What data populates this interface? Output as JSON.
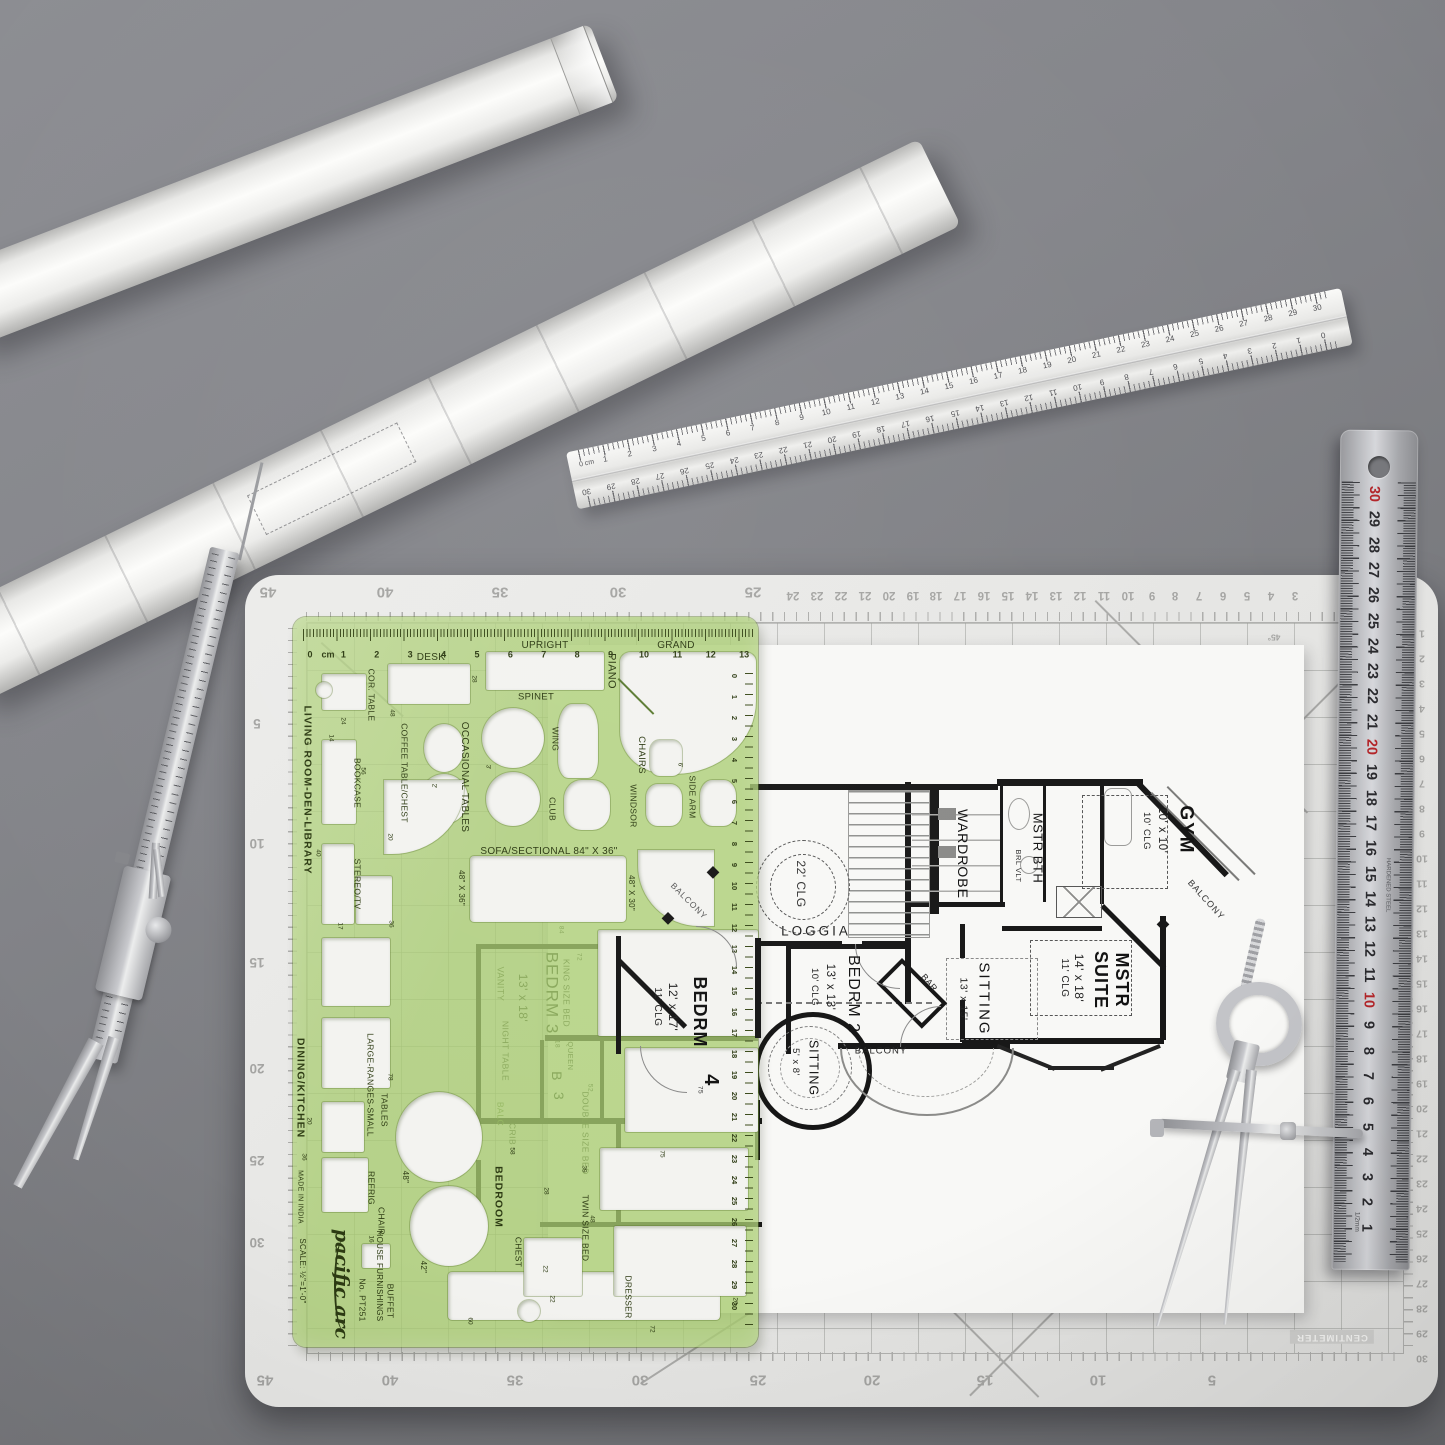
{
  "mat": {
    "top_major": [
      "45",
      "40",
      "35",
      "30",
      "25"
    ],
    "top_minor": [
      "24",
      "23",
      "22",
      "21",
      "20",
      "19",
      "18",
      "17",
      "16",
      "15",
      "14",
      "13",
      "12",
      "11",
      "10",
      "9",
      "8",
      "7",
      "6",
      "5",
      "4",
      "3"
    ],
    "bottom": [
      "45",
      "40",
      "35",
      "30",
      "25",
      "20",
      "15",
      "10",
      "5"
    ],
    "left": [
      "5",
      "10",
      "15",
      "20",
      "25",
      "30"
    ],
    "right": [
      "1",
      "2",
      "3",
      "4",
      "5",
      "6",
      "7",
      "8",
      "9",
      "10",
      "11",
      "12",
      "13",
      "14",
      "15",
      "16",
      "17",
      "18",
      "19",
      "20",
      "21",
      "22",
      "23",
      "24",
      "25",
      "26",
      "27",
      "28",
      "29",
      "30"
    ],
    "centimeter_label": "CENTIMETER",
    "angle_label": "45°"
  },
  "aluminum_ruler": {
    "zero_label": "0 cm",
    "numbers": [
      "1",
      "2",
      "3",
      "4",
      "5",
      "6",
      "7",
      "8",
      "9",
      "10",
      "11",
      "12",
      "13",
      "14",
      "15",
      "16",
      "17",
      "18",
      "19",
      "20",
      "21",
      "22",
      "23",
      "24",
      "25",
      "26",
      "27",
      "28",
      "29",
      "30"
    ],
    "end_zero": "0"
  },
  "steel_ruler": {
    "numbers": [
      "30",
      "29",
      "28",
      "27",
      "26",
      "25",
      "24",
      "23",
      "22",
      "21",
      "20",
      "19",
      "18",
      "17",
      "16",
      "15",
      "14",
      "13",
      "12",
      "11",
      "10",
      "9",
      "8",
      "7",
      "6",
      "5",
      "4",
      "3",
      "2",
      "1"
    ],
    "red_numbers": [
      "30",
      "20",
      "10"
    ],
    "brand": "HARDENED STEEL",
    "precision": "1/2mm"
  },
  "template": {
    "labels": {
      "desk": "DESK",
      "upright": "UPRIGHT",
      "piano": "PIANO",
      "grand": "GRAND",
      "spinet": "SPINET",
      "cor_table": "COR. TABLE",
      "living": "LIVING ROOM-DEN-LIBRARY",
      "bookcase": "BOOKCASE",
      "coffee": "COFFEE TABLE/CHEST",
      "occasional": "OCCASIONAL TABLES",
      "wing": "WING",
      "club": "CLUB",
      "chairs": "CHAIRS",
      "windsor": "WINDSOR",
      "side_arm": "SIDE ARM",
      "sofa": "SOFA/SECTIONAL 84\" X 36\"",
      "s4836": "48\" X 36\"",
      "s4830": "48\" X 30\"",
      "stereo": "STEREO/TV",
      "dining": "DINING/KITCHEN",
      "ranges": "LARGE-RANGES-SMALL",
      "tables": "TABLES",
      "refrig": "REFRIG",
      "chair": "CHAIR",
      "d48": "48\"",
      "d42": "42\"",
      "bedroom": "BEDROOM",
      "chest": "CHEST",
      "twin": "TWIN SIZE BED",
      "dresser": "DRESSER",
      "buffet": "BUFFET",
      "made": "MADE IN INDIA",
      "scale": "SCALE: ½\"=1'-0\"",
      "brand": "pacific arc",
      "model": "No. PT251",
      "product": "HOUSE FURNISHINGS",
      "cm_unit": "cm"
    },
    "cm_numbers": [
      "0",
      "1",
      "2",
      "3",
      "4",
      "5",
      "6",
      "7",
      "8",
      "9",
      "10",
      "11",
      "12",
      "13"
    ],
    "edge_numbers": [
      "0",
      "1",
      "2",
      "3",
      "4",
      "5",
      "6",
      "7",
      "8",
      "9",
      "10",
      "11",
      "12",
      "13",
      "14",
      "15",
      "16",
      "17",
      "18",
      "19",
      "20",
      "21",
      "22",
      "23",
      "24",
      "25",
      "26",
      "27",
      "28",
      "29",
      "30"
    ],
    "dims": [
      "28",
      "48",
      "24",
      "56",
      "20",
      "40",
      "17",
      "36",
      "2'",
      "3'",
      "6'",
      "78",
      "20",
      "36",
      "16",
      "58",
      "28",
      "39",
      "48",
      "22",
      "22",
      "75",
      "60",
      "72",
      "20",
      "14"
    ]
  },
  "floorplan": {
    "rooms": {
      "clg22": "22' CLG",
      "loggia": "LOGGIA",
      "gym": "GYM",
      "gym_size": "10' x 10'",
      "gym_clg": "10' CLG",
      "wardrobe": "WARDROBE",
      "mstr_bth": "MSTR BTH",
      "brl_vlt": "BRL VLT",
      "balcony_right": "BALCONY",
      "mstr1": "MSTR",
      "mstr2": "SUITE",
      "mstr_size": "14' x 18'",
      "mstr_clg": "11' CLG",
      "sitting1": "SITTING",
      "sitting1_size": "13' x 15'",
      "bar": "BAR",
      "bedrm2": "BEDRM 2",
      "bedrm2_size": "13' x 13'",
      "bedrm2_clg": "10' CLG",
      "sitting2": "SITTING",
      "sitting2_size": "5' x 8'",
      "balcony_center": "BALCONY",
      "bedrm4": "BEDRM",
      "bedrm4_size": "12' x 17'",
      "bedrm4_clg": "11' CLG",
      "bedrm4_num": "4",
      "bedrm4_dim": "75",
      "bedrm3": "BEDRM 3",
      "bedrm3_size": "13' x 18'",
      "vanity": "VANITY",
      "king": "KING SIZE BED",
      "king_dim": "72",
      "queen": "QUEEN",
      "night": "NIGHT TABLE",
      "bigB": "B",
      "big3": "3",
      "double": "DOUBLE SIZE BED",
      "double_dim": "52",
      "crib": "CRIB",
      "balc": "BALC",
      "balcony_tl": "BALCONY",
      "dim84": "84",
      "dim18": "18"
    }
  }
}
